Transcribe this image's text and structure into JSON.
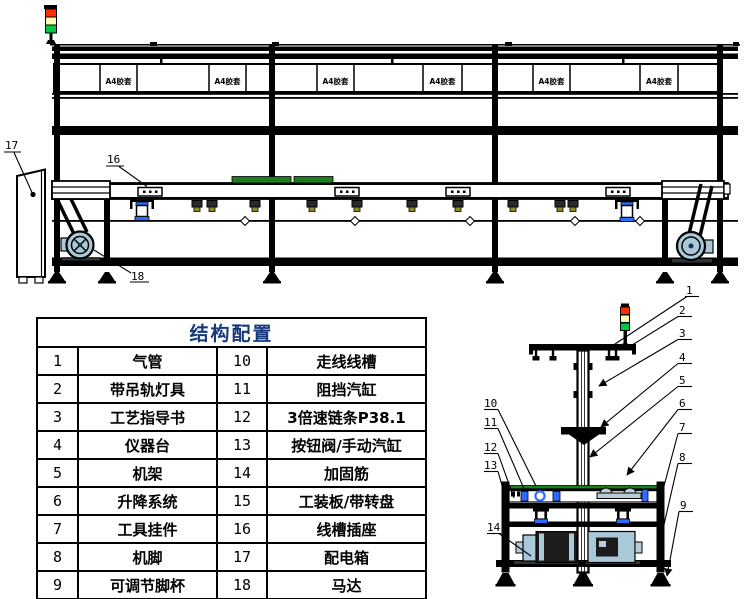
{
  "table": {
    "title": "结构配置",
    "title_color": "#16387c",
    "rows": [
      [
        "1",
        "气管",
        "10",
        "走线线槽"
      ],
      [
        "2",
        "带吊轨灯具",
        "11",
        "阻挡汽缸"
      ],
      [
        "3",
        "工艺指导书",
        "12",
        "3倍速链条P38.1"
      ],
      [
        "4",
        "仪器台",
        "13",
        "按钮阀/手动汽缸"
      ],
      [
        "5",
        "机架",
        "14",
        "加固筋"
      ],
      [
        "6",
        "升降系统",
        "15",
        "工装板/带转盘"
      ],
      [
        "7",
        "工具挂件",
        "16",
        "线槽插座"
      ],
      [
        "8",
        "机脚",
        "17",
        "配电箱"
      ],
      [
        "9",
        "可调节脚杯",
        "18",
        "马达"
      ]
    ]
  },
  "side_view": {
    "panel_labels": [
      "A4胶套",
      "A4胶套",
      "A4胶套",
      "A4胶套",
      "A4胶套",
      "A4胶套"
    ],
    "callout_17": "17",
    "callout_16": "16",
    "callout_18": "18"
  },
  "end_view": {
    "callouts_right": [
      "1",
      "2",
      "3",
      "4",
      "5",
      "6",
      "7",
      "8",
      "9"
    ],
    "callouts_left": [
      "10",
      "11",
      "12",
      "13",
      "14"
    ]
  },
  "colors": {
    "signal_red": "#ff2d00",
    "signal_yellow": "#ffffb4",
    "signal_green": "#00c845",
    "pallet_green": "#1e7d1e",
    "motor_blue": "#a9c9d9",
    "valve_blue": "#2e6bff",
    "bolt_olive": "#8a8a1e",
    "table_title_blue": "#16387c",
    "line": "#000000"
  }
}
